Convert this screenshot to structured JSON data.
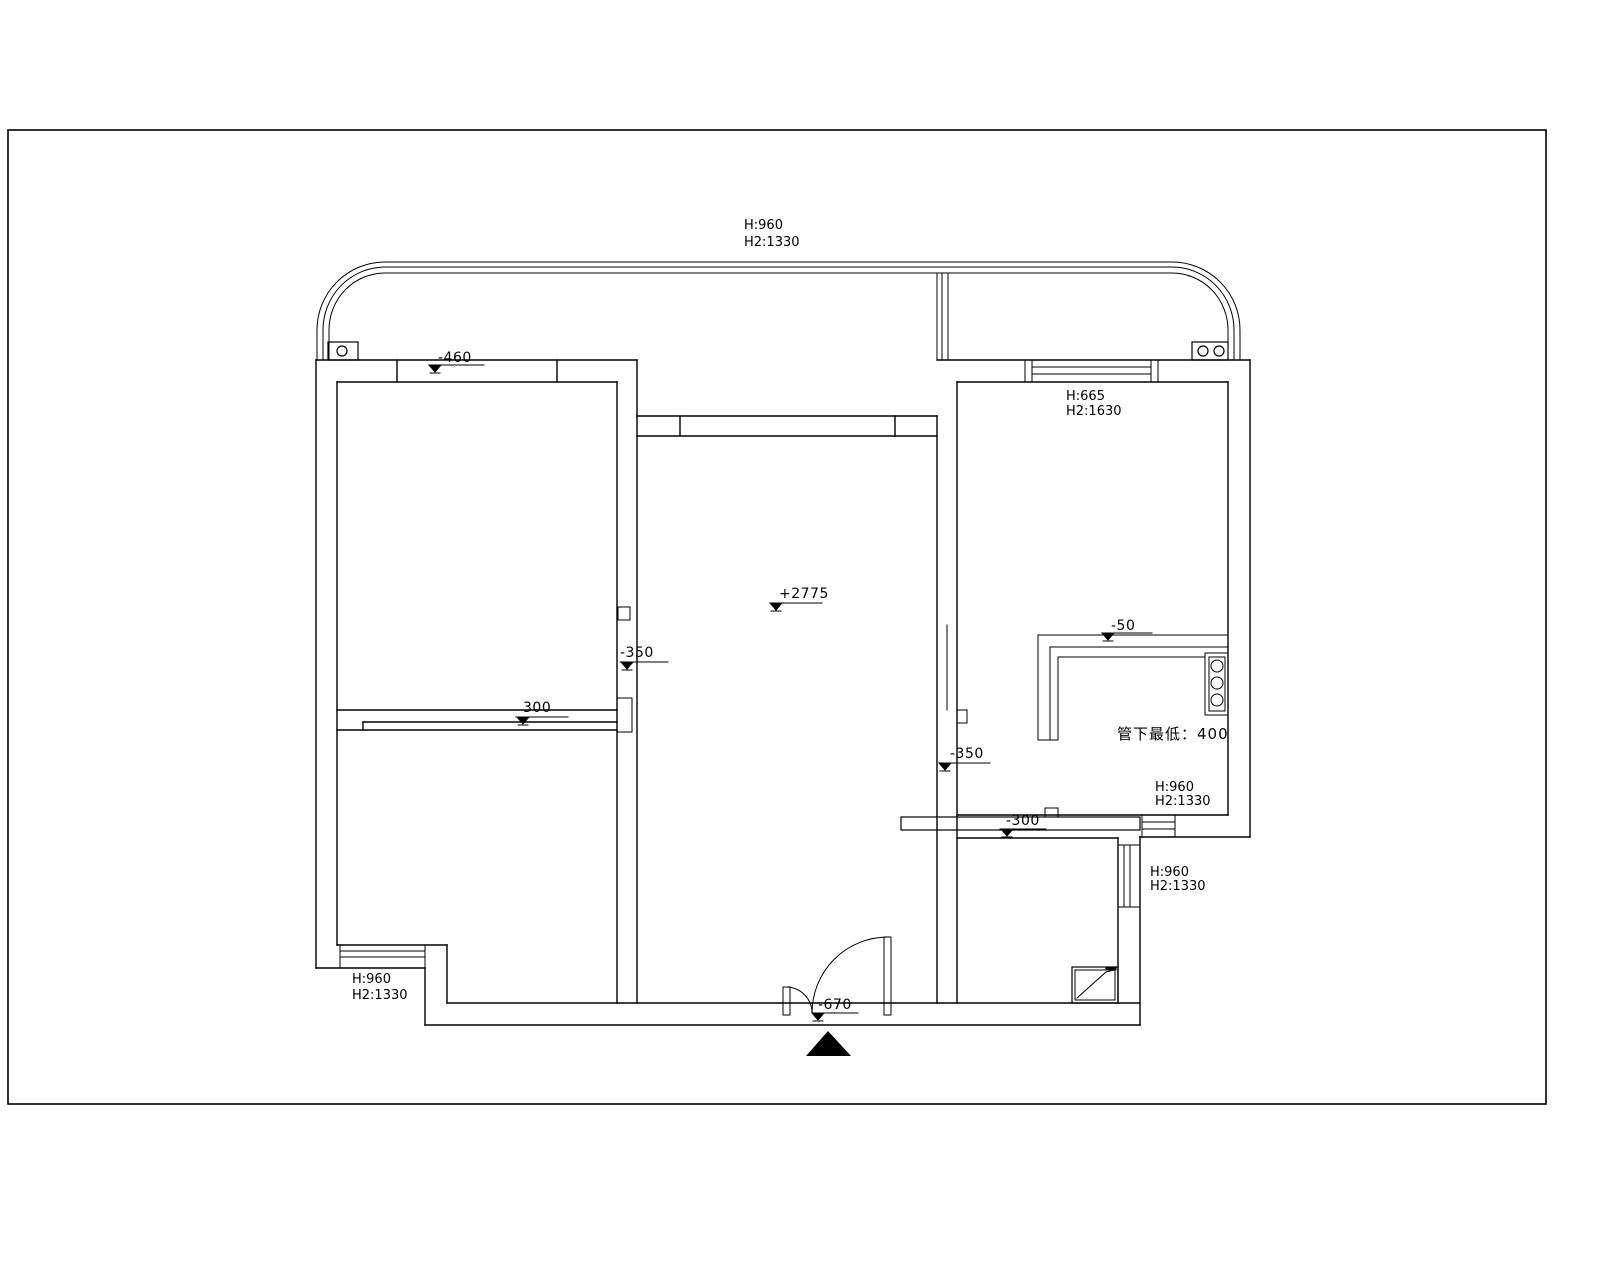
{
  "labels": {
    "balcony_top": {
      "h": "H:960",
      "h2": "H2:1330"
    },
    "kitchen_top_window": {
      "h": "H:665",
      "h2": "H2:1630"
    },
    "bedroom2_window": {
      "h": "H:960",
      "h2": "H2:1330"
    },
    "kitchen_bottom_window": {
      "h": "H:960",
      "h2": "H2:1330"
    },
    "bathroom_window": {
      "h": "H:960",
      "h2": "H2:1330"
    },
    "pipe_note": "管下最低：400"
  },
  "elevation_markers": {
    "balcony_left": "-460",
    "bedroom_divider": "300",
    "living_west": "-350",
    "living_center": "+2775",
    "living_east": "-350",
    "kitchen_counter": "-50",
    "bathroom_sill": "-300",
    "entry": "-670"
  },
  "icons": {
    "north_arrow": "filled-triangle-up",
    "elevation_symbol": "filled-triangle-down-with-tick",
    "stove": "three-burner-column",
    "shower_tray": "rect-with-diagonal",
    "columns": "circle-in-box"
  },
  "colors": {
    "line": "#000000",
    "background": "#ffffff"
  }
}
